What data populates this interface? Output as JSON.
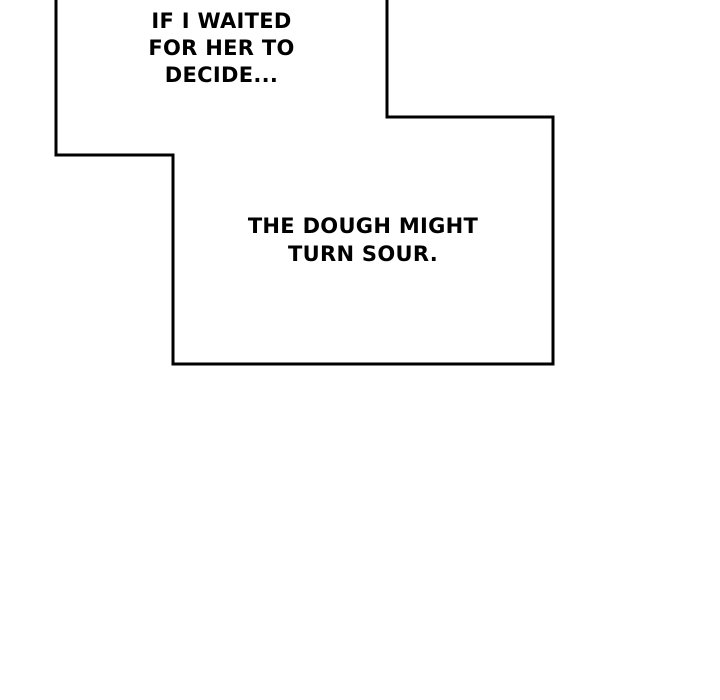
{
  "panel": {
    "background_color": "#ffffff",
    "ink_color": "#000000",
    "bubble_fill_color": "#ffffff"
  },
  "bubbles": [
    {
      "id": "bubble-1",
      "lines": [
        "IF I WAITED",
        "FOR HER TO",
        "DECIDE..."
      ]
    },
    {
      "id": "bubble-2",
      "lines": [
        "THE DOUGH MIGHT",
        "TURN SOUR."
      ]
    }
  ]
}
